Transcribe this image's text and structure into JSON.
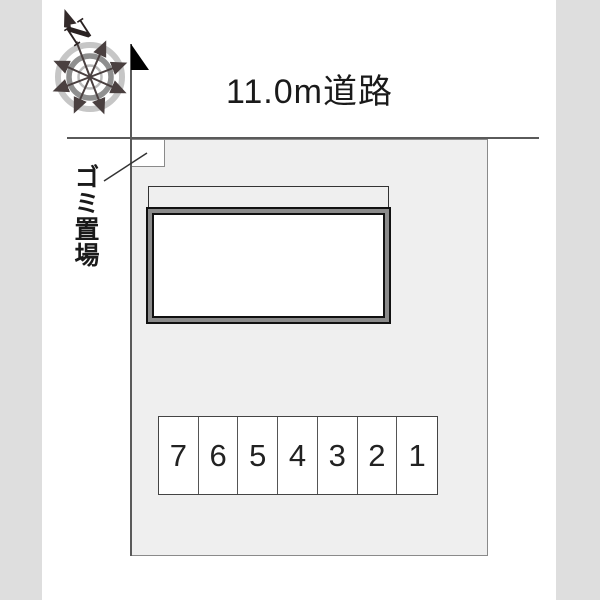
{
  "plan": {
    "road_label": "11.0m道路",
    "garbage_label": "ゴミ置場",
    "compass_north": "N",
    "parking_spaces": [
      "7",
      "6",
      "5",
      "4",
      "3",
      "2",
      "1"
    ],
    "colors": {
      "background": "#ffffff",
      "margin_strip": "#dedede",
      "parcel_fill": "#efefef",
      "boundary_line": "#5a5a5a",
      "building_band": "#8a8a8a",
      "building_outline": "#111111",
      "compass_ring_outer": "#c6c6c6",
      "compass_ring_middle": "#8f8f8f",
      "compass_ring_inner": "#bcbcbc",
      "compass_spoke": "#4a4040",
      "text": "#1a1a1a"
    }
  }
}
